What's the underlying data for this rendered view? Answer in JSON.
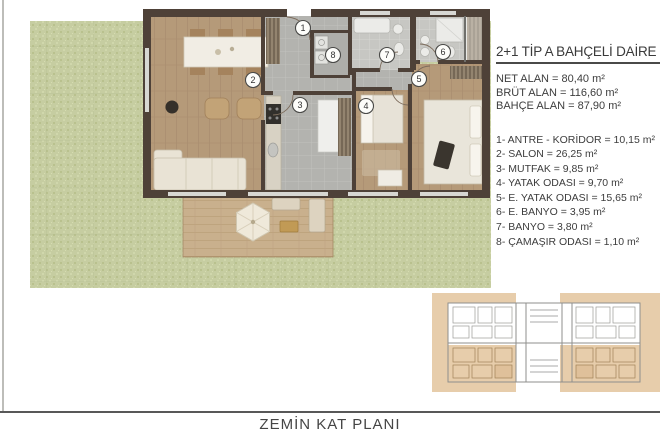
{
  "header": {
    "title": "2+1 TİP A BAHÇELİ DAİRE"
  },
  "areas": {
    "net": "NET ALAN = 80,40 m²",
    "brut": "BRÜT ALAN = 116,60 m²",
    "bahce": "BAHÇE ALAN = 87,90 m²"
  },
  "room_list": [
    "1- ANTRE - KORİDOR = 10,15 m²",
    "2- SALON = 26,25 m²",
    "3- MUTFAK = 9,85 m²",
    "4- YATAK ODASI = 9,70 m²",
    "5- E. YATAK ODASI = 15,65 m²",
    "6- E. BANYO = 3,95 m²",
    "7- BANYO = 3,80 m²",
    "8- ÇAMAŞIR ODASI = 1,10 m²"
  ],
  "plan": {
    "numbers": [
      "1",
      "2",
      "3",
      "4",
      "5",
      "6",
      "7",
      "8"
    ]
  },
  "footer": {
    "caption": "ZEMİN KAT PLANI"
  },
  "colors": {
    "grass": "#c6cda1",
    "wall": "#4e4138",
    "wood": "#b59a79",
    "deck": "#c9b08d",
    "tile": "#b3b3af",
    "bath_tile": "#c7c7c3",
    "highlight": "#e7cdab",
    "text": "#3d3d3d"
  }
}
